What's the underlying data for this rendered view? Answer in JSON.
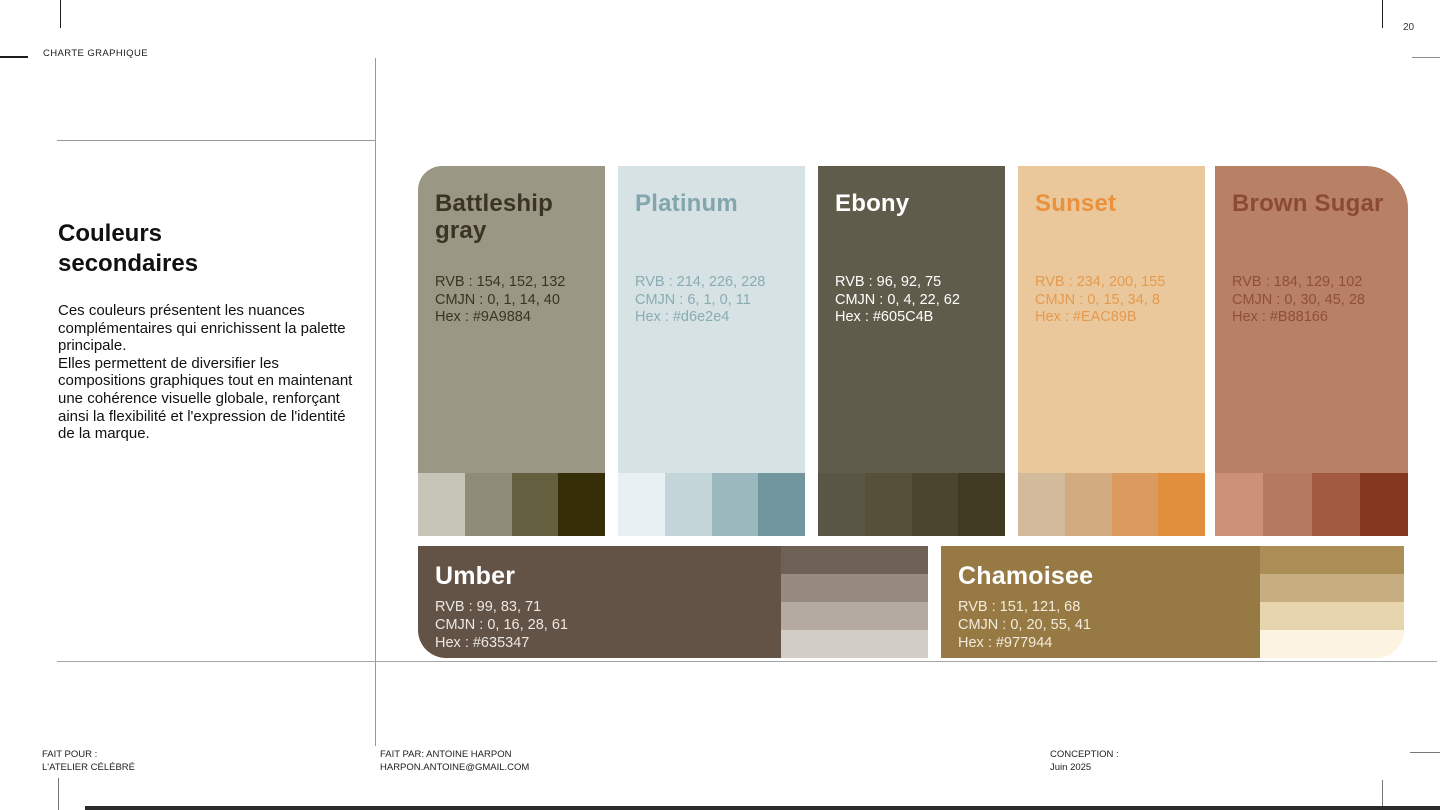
{
  "page": {
    "number": "20",
    "header_label": "CHARTE GRAPHIQUE"
  },
  "intro": {
    "title": "Couleurs secondaires",
    "description": "Ces couleurs présentent les nuances complémentaires qui enrichissent la palette principale.\nElles permettent de diversifier les compositions graphiques tout en maintenant une cohérence visuelle globale, renforçant ainsi la flexibilité et l'expression de l'identité de la marque."
  },
  "cards": [
    {
      "name": "Battleship gray",
      "bg": "#9A9884",
      "title_color": "#3b3424",
      "text_color": "#3b3424",
      "rvb": "RVB : 154, 152, 132",
      "cmjn": "CMJN : 0, 1, 14, 40",
      "hex": "Hex : #9A9884",
      "swatches": [
        "#c7c5b7",
        "#8f8c78",
        "#645f3e",
        "#352e07"
      ]
    },
    {
      "name": "Platinum",
      "bg": "#d6e2e4",
      "title_color": "#83a6ad",
      "text_color": "#8aacb2",
      "rvb": "RVB : 214, 226, 228",
      "cmjn": "CMJN : 6, 1, 0, 11",
      "hex": "Hex : #d6e2e4",
      "swatches": [
        "#e7f1f3",
        "#c3d5d9",
        "#9ab8bd",
        "#72969d"
      ]
    },
    {
      "name": "Ebony",
      "bg": "#605C4B",
      "title_color": "#ffffff",
      "text_color": "#ffffff",
      "rvb": "RVB : 96, 92, 75",
      "cmjn": "CMJN : 0, 4, 22, 62",
      "hex": "Hex : #605C4B",
      "swatches": [
        "#5a5645",
        "#54503a",
        "#4b4530",
        "#413a23"
      ]
    },
    {
      "name": "Sunset",
      "bg": "#EAC89B",
      "title_color": "#e9913c",
      "text_color": "#e49a4f",
      "rvb": "RVB : 234, 200, 155",
      "cmjn": "CMJN : 0, 15, 34, 8",
      "hex": "Hex : #EAC89B",
      "swatches": [
        "#d2ba9b",
        "#d3ab81",
        "#db9b5e",
        "#e28f3d"
      ]
    },
    {
      "name": "Brown Sugar",
      "bg": "#B88166",
      "title_color": "#8b4a32",
      "text_color": "#8f4f37",
      "rvb": "RVB : 184, 129, 102",
      "cmjn": "CMJN : 0, 30, 45, 28",
      "hex": "Hex : #B88166",
      "swatches": [
        "#cb9078",
        "#b37a5f",
        "#a25b41",
        "#86381f"
      ]
    }
  ],
  "wide_cards": [
    {
      "name": "Umber",
      "bg": "#635347",
      "title_color": "#ffffff",
      "text_color": "#ece7e3",
      "rvb": "RVB : 99, 83, 71",
      "cmjn": "CMJN : 0, 16, 28, 61",
      "hex": "Hex : #635347",
      "stripes": [
        "#6d6054",
        "#97897f",
        "#b5aaa2",
        "#d3cdc8"
      ]
    },
    {
      "name": "Chamoisee",
      "bg": "#977944",
      "title_color": "#ffffff",
      "text_color": "#f3ecdc",
      "rvb": "RVB : 151, 121, 68",
      "cmjn": "CMJN : 0, 20, 55, 41",
      "hex": "Hex : #977944",
      "stripes": [
        "#ab8e55",
        "#c7ae80",
        "#e7d5ae",
        "#fcf3e1"
      ]
    }
  ],
  "footer": {
    "made_for_label": "FAIT POUR :",
    "made_for_value": "L'ATELIER CÉLÉBRÉ",
    "made_by_label": "FAIT PAR: ANTOINE HARPON",
    "made_by_value": "HARPON.ANTOINE@GMAIL.COM",
    "conception_label": "CONCEPTION :",
    "conception_value": "Juin 2025"
  }
}
